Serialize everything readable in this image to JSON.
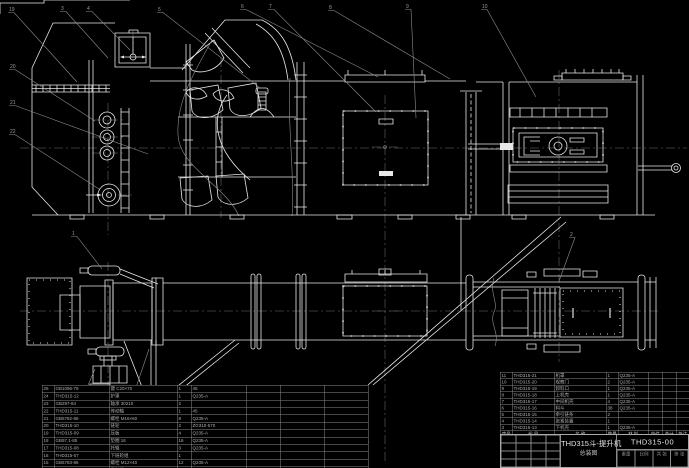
{
  "drawing": {
    "title_line1": "THD315斗-提升机",
    "title_line2": "总装图",
    "drawing_no": "THD315-00",
    "bottom_fields": [
      "重量",
      "比例",
      "共 张",
      "第 张"
    ]
  },
  "colors": {
    "background": "#000000",
    "line_white": "#e8e8e8",
    "leader_gray": "#8f8f8f",
    "centerline_gray": "#6e6e6e",
    "bom_text": "#aeaeae",
    "watermark_gray": "#3d3d3d"
  },
  "bom_right": {
    "header": [
      "序号",
      "代 号",
      "名 称",
      "数量",
      "材 料",
      "单件",
      "总计",
      "备注"
    ],
    "rows": [
      [
        "11",
        "THD315-21",
        "机罩",
        "1",
        "Q235-A",
        "",
        "",
        ""
      ],
      [
        "10",
        "THD315-20",
        "观察门",
        "2",
        "Q235-A",
        "",
        "",
        ""
      ],
      [
        "9",
        "THD315-19",
        "卸料口",
        "1",
        "Q235-A",
        "",
        "",
        ""
      ],
      [
        "8",
        "THD315-18",
        "上机壳",
        "1",
        "Q235-A",
        "",
        "",
        ""
      ],
      [
        "7",
        "THD315-17",
        "中间机壳",
        "4",
        "Q235-A",
        "",
        "",
        ""
      ],
      [
        "6",
        "THD315-16",
        "料斗",
        "38",
        "Q235-A",
        "",
        "",
        ""
      ],
      [
        "5",
        "THD315-15",
        "牵引链条",
        "2",
        "",
        "",
        "",
        ""
      ],
      [
        "4",
        "THD315-14",
        "张紧装置",
        "1",
        "",
        "",
        "",
        ""
      ],
      [
        "3",
        "THD315-13",
        "下机壳",
        "1",
        "Q235-A",
        "",
        "",
        ""
      ]
    ]
  },
  "bom_left": {
    "rows": [
      [
        "25",
        "GB1096-79",
        "键 C20×70",
        "1",
        "45",
        "",
        "",
        ""
      ],
      [
        "24",
        "THD315-12",
        "护罩",
        "1",
        "Q235-A",
        "",
        "",
        ""
      ],
      [
        "23",
        "GB297-84",
        "轴承 30210",
        "2",
        "",
        "",
        "",
        ""
      ],
      [
        "22",
        "THD315-11",
        "传动轴",
        "1",
        "45",
        "",
        "",
        ""
      ],
      [
        "21",
        "GB5782-86",
        "螺栓 M16×60",
        "8",
        "Q235-A",
        "",
        "",
        ""
      ],
      [
        "20",
        "THD315-10",
        "链轮",
        "2",
        "ZG310-570",
        "",
        "",
        ""
      ],
      [
        "19",
        "THD315-09",
        "压板",
        "4",
        "Q235-A",
        "",
        "",
        ""
      ],
      [
        "18",
        "GB97.1-85",
        "垫圈 16",
        "16",
        "Q235-A",
        "",
        "",
        ""
      ],
      [
        "17",
        "THD315-08",
        "托辊",
        "3",
        "Q235-A",
        "",
        "",
        ""
      ],
      [
        "16",
        "THD315-07",
        "下链轮组",
        "1",
        "",
        "",
        "",
        ""
      ],
      [
        "15",
        "GB5783-86",
        "螺栓 M12×40",
        "12",
        "Q235-A",
        "",
        "",
        ""
      ],
      [
        "14",
        "THD315-06",
        "导料板",
        "2",
        "Q235-A",
        "",
        "",
        ""
      ]
    ]
  },
  "balloons": [
    {
      "label": "3",
      "x": 61,
      "y": 10,
      "tx": 108,
      "ty": 58
    },
    {
      "label": "4",
      "x": 87,
      "y": 10,
      "tx": 130,
      "ty": 50
    },
    {
      "label": "5",
      "x": 158,
      "y": 11,
      "tx": 260,
      "ty": 88
    },
    {
      "label": "6",
      "x": 241,
      "y": 8,
      "tx": 378,
      "ty": 77
    },
    {
      "label": "7",
      "x": 269,
      "y": 8,
      "tx": 376,
      "ty": 112
    },
    {
      "label": "8",
      "x": 329,
      "y": 9,
      "tx": 450,
      "ty": 79
    },
    {
      "label": "9",
      "x": 406,
      "y": 8,
      "tx": 416,
      "ty": 118
    },
    {
      "label": "10",
      "x": 482,
      "y": 8,
      "tx": 536,
      "ty": 97
    },
    {
      "label": "19",
      "x": 9,
      "y": 11,
      "tx": 77,
      "ty": 82
    },
    {
      "label": "20",
      "x": 10,
      "y": 68,
      "tx": 95,
      "ty": 121
    },
    {
      "label": "21",
      "x": 10,
      "y": 104,
      "tx": 148,
      "ty": 154
    },
    {
      "label": "22",
      "x": 10,
      "y": 133,
      "tx": 99,
      "ty": 189
    },
    {
      "label": "1",
      "x": 72,
      "y": 235,
      "tx": 102,
      "ty": 269
    },
    {
      "label": "2",
      "x": 570,
      "y": 236,
      "tx": 559,
      "ty": 281
    },
    {
      "label": "23",
      "x": 53,
      "y": 438,
      "tx": 89,
      "ty": 399
    },
    {
      "label": "18",
      "x": 55,
      "y": 448,
      "tx": 95,
      "ty": 369
    },
    {
      "label": "17",
      "x": 66,
      "y": 448,
      "tx": 102,
      "ty": 389
    },
    {
      "label": "16",
      "x": 76,
      "y": 448,
      "tx": 111,
      "ty": 394
    },
    {
      "label": "15",
      "x": 88,
      "y": 448,
      "tx": 119,
      "ty": 409
    },
    {
      "label": "14",
      "x": 110,
      "y": 448,
      "tx": 149,
      "ty": 349
    },
    {
      "label": "13",
      "x": 255,
      "y": 448,
      "tx": 329,
      "ty": 409
    },
    {
      "label": "12",
      "x": 281,
      "y": 449,
      "tx": 366,
      "ty": 430
    },
    {
      "label": "11",
      "x": 289,
      "y": 449,
      "tx": 367,
      "ty": 434
    },
    {
      "label": "24",
      "x": 296,
      "y": 449,
      "tx": 368,
      "ty": 438
    },
    {
      "label": "25",
      "x": 303,
      "y": 449,
      "tx": 369,
      "ty": 442
    }
  ]
}
